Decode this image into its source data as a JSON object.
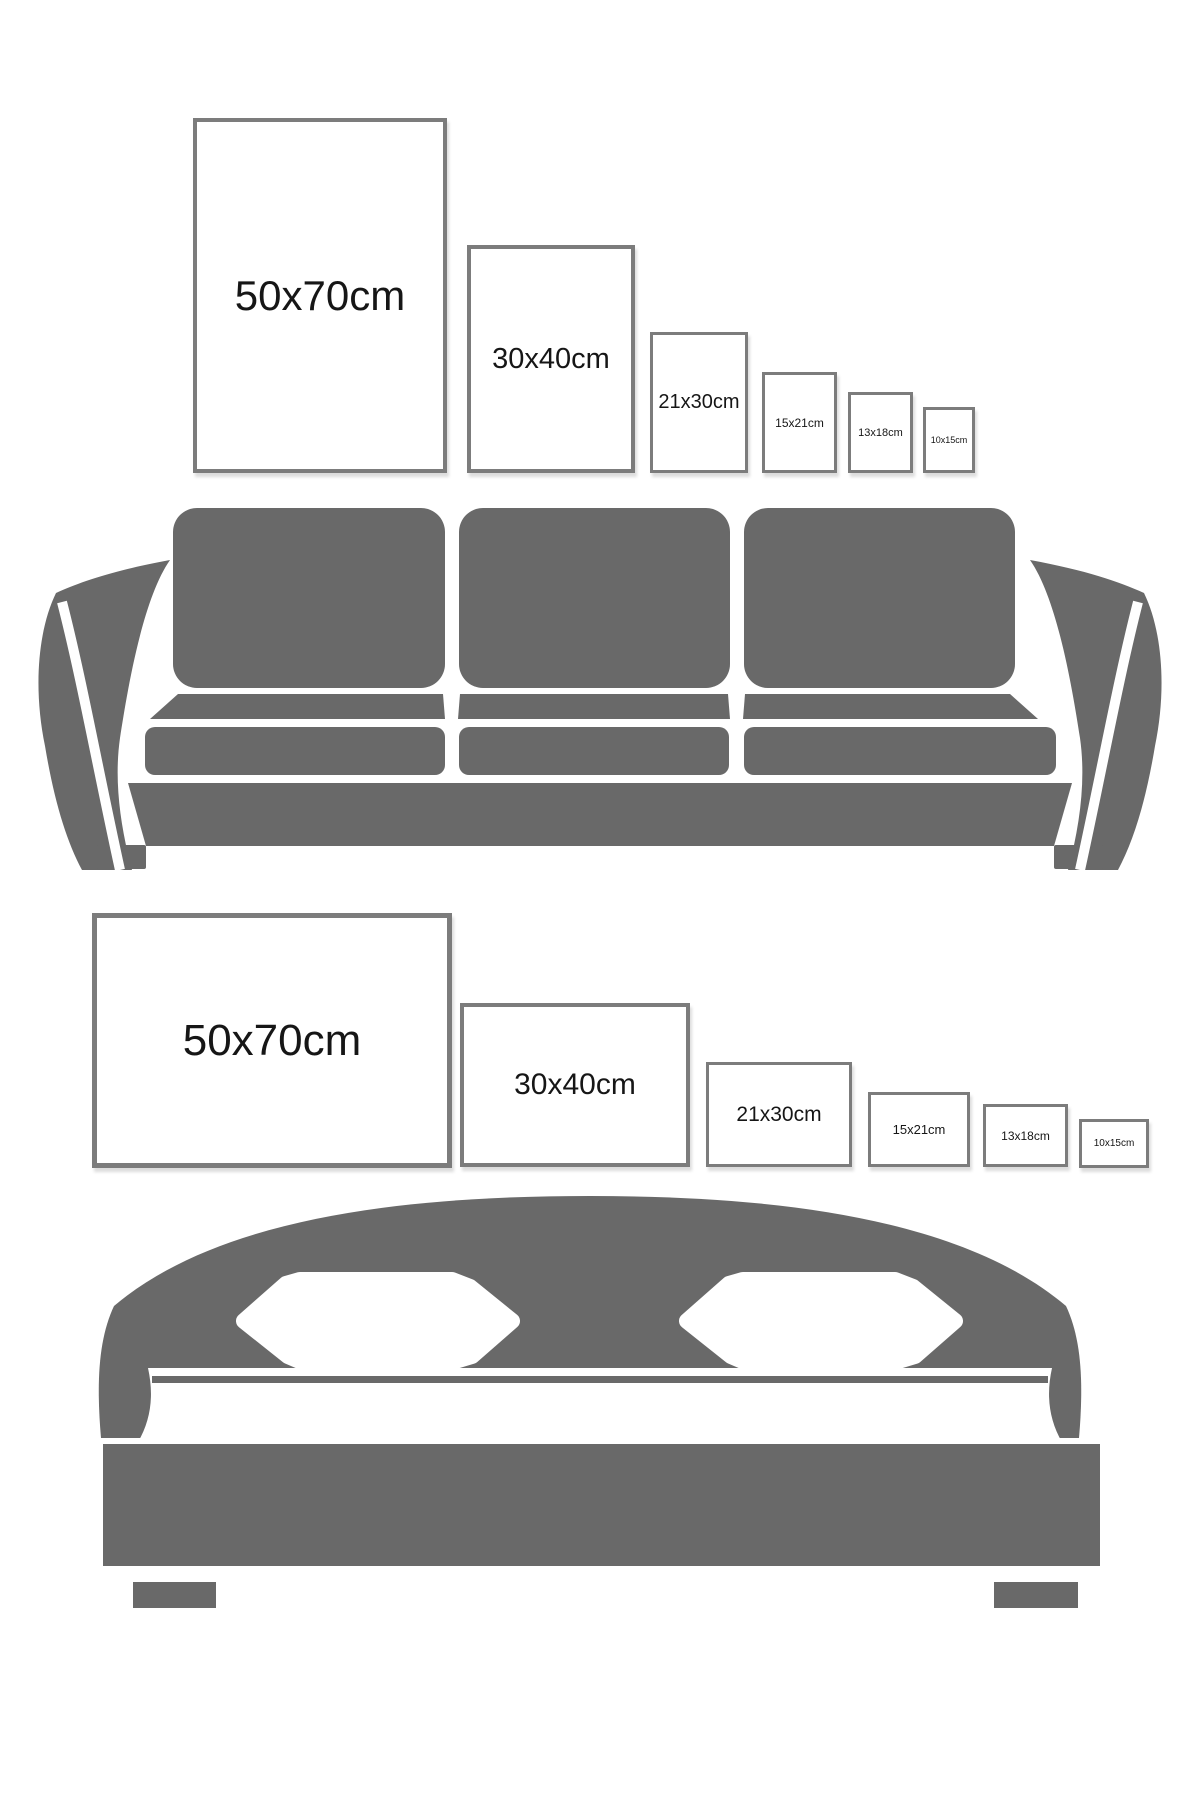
{
  "colors": {
    "furniture": "#696969",
    "frame_border": "#7c7c7c",
    "label_text": "#161616",
    "background": "#ffffff"
  },
  "sofa_section": {
    "orientation": "portrait",
    "furniture": "sofa",
    "frames": [
      {
        "label": "50x70cm"
      },
      {
        "label": "30x40cm"
      },
      {
        "label": "21x30cm"
      },
      {
        "label": "15x21cm"
      },
      {
        "label": "13x18cm"
      },
      {
        "label": "10x15cm"
      }
    ]
  },
  "bed_section": {
    "orientation": "landscape",
    "furniture": "bed",
    "frames": [
      {
        "label": "50x70cm"
      },
      {
        "label": "30x40cm"
      },
      {
        "label": "21x30cm"
      },
      {
        "label": "15x21cm"
      },
      {
        "label": "13x18cm"
      },
      {
        "label": "10x15cm"
      }
    ]
  }
}
